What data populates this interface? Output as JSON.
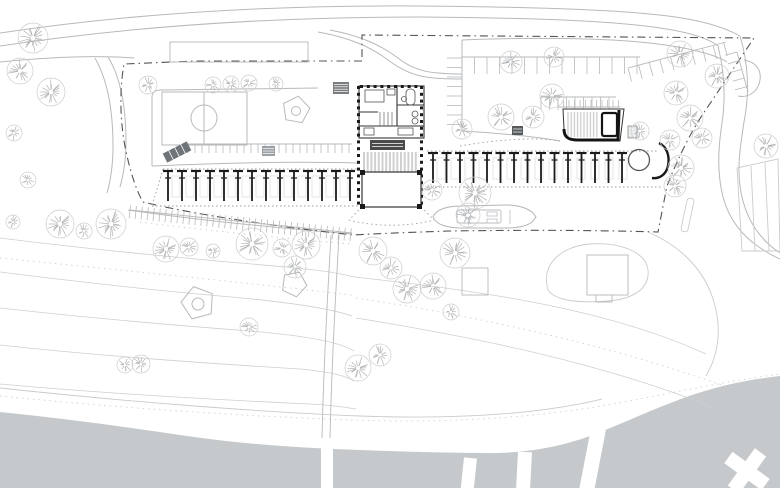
{
  "drawing_type": "architectural-site-plan",
  "colors": {
    "paper": "#ffffff",
    "water": "#c6c9cb",
    "line": "#b7b9bb",
    "faint": "#c9cbcd",
    "contour": "#cdcfd1",
    "tree": "#b2b4b6",
    "treeLight": "#cbcdcf",
    "dark": "#1a1a1c",
    "wall": "#333333",
    "boundary": "#545454",
    "deckStripe": "#d0d0d0",
    "stage": "#4a4a4a",
    "rampFill": "#6e7478",
    "boatFaint": "#dedede"
  },
  "site": {
    "water": {
      "shore": "M0,412 C60,418 120,426 180,435 C240,444 300,448 360,450 C410,452 455,453 490,453 C530,453 562,446 590,436 C622,424 652,409 692,395 C732,382 756,379 780,376 L780,488 L0,488 Z",
      "piers": [
        {
          "x": 321,
          "y": 438,
          "w": 12,
          "h": 52,
          "rot": 0
        },
        {
          "x": 464,
          "y": 458,
          "w": 13,
          "h": 32,
          "rot": 6
        },
        {
          "x": 518,
          "y": 452,
          "w": 14,
          "h": 38,
          "rot": 3
        },
        {
          "x": 591,
          "y": 429,
          "w": 15,
          "h": 62,
          "rot": 11
        }
      ],
      "cross": {
        "cx": 747,
        "cy": 471,
        "len": 46,
        "wid": 14,
        "rot": 36
      }
    },
    "contours": [
      "M0,238 C80,248 160,256 240,263 C300,268 332,271 354,277",
      "M0,272 C80,282 150,290 220,296 C290,302 332,309 352,316",
      "M0,308 C90,318 170,325 250,331 C310,336 342,343 354,351",
      "M0,345 C100,356 200,363 300,369 C332,372 346,376 354,381",
      "M0,384 C100,393 200,399 310,404 C330,405 344,407 356,409",
      "M354,277 C420,284 480,292 532,302 C600,315 660,333 706,354",
      "M356,318 C430,330 510,345 580,364 C636,379 680,394 714,408"
    ],
    "contours_dotted": [
      "M0,258 C120,270 240,282 352,295",
      "M356,298 C450,312 546,332 634,357 C684,372 722,385 752,395",
      "M0,396 C120,408 240,416 352,420 C470,424 560,415 640,399 C700,387 742,379 780,374",
      "M140,222 C220,232 300,240 352,244"
    ],
    "roads": [
      "M0,33 C140,12 280,5 420,6 C540,7 622,10 668,16 C700,20 724,27 740,36",
      "M0,46 C140,25 280,17 420,17 C540,18 614,21 660,28 C688,32 708,38 718,46",
      "M0,62 C50,57 96,55 134,58",
      "M108,57 C120,76 126,106 126,141 C126,159 124,173 120,187",
      "M95,58 C107,79 113,109 113,146 C113,164 111,179 107,193",
      "M318,32 C352,38 372,48 388,60 C400,69 412,75 426,77 C438,79 450,79 462,79",
      "M330,30 C362,36 382,46 398,58 C408,66 422,72 438,73 C448,74 456,74 462,74",
      "M740,36 C748,62 750,92 744,122 C740,148 736,172 742,197 C748,223 762,241 780,253",
      "M718,46 C724,70 726,96 722,123 C718,149 717,173 723,197 C729,219 741,235 759,247 C766,252 773,256 780,259",
      "M744,60 C757,62 763,72 759,84 C756,93 747,98 738,96",
      "M462,40 L462,131",
      "M462,40 C540,37 612,38 658,44 C690,48 716,55 727,62",
      "M462,131 C500,133 538,137 560,141",
      "M152,166 L152,97 C152,92 155,90 161,90 L318,88",
      "M152,166 C220,163 290,161 357,163",
      "M128,210 C190,219 265,227 352,234"
    ],
    "faint_paths": [
      "M737,168 L778,159 L780,251 L742,251 Z",
      "M751,166 L755,251",
      "M765,163 L769,251",
      "M548,290 C540,264 562,246 590,244 C620,242 646,252 648,270 C650,288 634,299 608,301 C584,303 556,302 548,290",
      "M648,232 C680,246 702,268 712,296 C722,324 720,352 706,376",
      "M0,388 C130,402 260,412 360,416 C470,420 548,412 602,399"
    ],
    "median": {
      "x": 684,
      "y": 198,
      "w": 7,
      "h": 34,
      "rot": 12
    },
    "boundary": "M362,61 L196,61 L124,64 C119,92 120,126 127,156 C131,173 136,190 143,202 C192,214 272,226 353,235 C390,233 420,232 450,231 C520,230 590,230 658,232 L667,186 C678,158 691,131 707,108 L754,38 L362,35 Z",
    "court": {
      "x": 162,
      "y": 92,
      "w": 85,
      "h": 53,
      "cx": 204,
      "cy": 118,
      "r": 13
    },
    "pentagons": [
      {
        "cx": 296,
        "cy": 110,
        "r": 14,
        "rot": -80,
        "ir": 4.5
      },
      {
        "cx": 198,
        "cy": 303,
        "r": 17,
        "rot": -105,
        "ir": 6
      },
      {
        "cx": 294,
        "cy": 284,
        "r": 13,
        "rot": -65,
        "ir": 0
      }
    ],
    "squares": [
      {
        "x": 170,
        "y": 42,
        "w": 138,
        "h": 20
      },
      {
        "x": 462,
        "y": 268,
        "w": 26,
        "h": 27
      },
      {
        "x": 587,
        "y": 255,
        "w": 41,
        "h": 40
      },
      {
        "x": 596,
        "y": 295,
        "w": 16,
        "h": 7
      }
    ],
    "tick_rows": [
      {
        "x1": 462,
        "y1": 57,
        "x2": 640,
        "y2": 57,
        "len": 17,
        "sp": 12.5,
        "side": 1
      },
      {
        "x1": 462,
        "y1": 58,
        "x2": 462,
        "y2": 130,
        "len": 15,
        "sp": 9.5,
        "side": 1
      },
      {
        "x1": 541,
        "y1": 97,
        "x2": 616,
        "y2": 97,
        "len": 13,
        "sp": 8.5,
        "side": 1
      },
      {
        "x1": 628,
        "y1": 68,
        "x2": 726,
        "y2": 42,
        "len": 14,
        "sp": 11,
        "side": 1
      },
      {
        "x1": 737,
        "y1": 52,
        "x2": 748,
        "y2": 92,
        "len": 12,
        "sp": 9,
        "side": 1
      },
      {
        "x1": 188,
        "y1": 144,
        "x2": 352,
        "y2": 144,
        "len": 9,
        "sp": 7,
        "side": 1
      },
      {
        "x1": 558,
        "y1": 107,
        "x2": 620,
        "y2": 107,
        "len": 7,
        "sp": 5.5,
        "side": -1
      },
      {
        "x1": 130,
        "y1": 210,
        "x2": 352,
        "y2": 233,
        "len": 13,
        "sp": 6,
        "side": 2
      }
    ],
    "rack_rows": [
      {
        "x0": 168,
        "x1": 350,
        "n": 14,
        "y": 171,
        "stem": 30,
        "boat_y": 176,
        "band": [
          "M163,169 L357,169",
          "M152,206 L362,206",
          "M163,169 L152,206"
        ]
      },
      {
        "x0": 433,
        "x1": 622,
        "n": 15,
        "y": 153,
        "stem": 30,
        "boat_y": 158,
        "band": [
          "M427,151 L657,151",
          "M427,187 L663,187"
        ]
      }
    ],
    "row_end": {
      "circle": {
        "cx": 639,
        "cy": 160,
        "r": 10.5
      },
      "hook": "M659,143 C667,147 670,156 668,166 C666,175 659,179 652,178"
    },
    "dotted_lines": [
      "M362,207 L349,220",
      "M421,207 L434,220",
      "M349,220 C375,227 408,227 434,220",
      "M460,146 C500,139 538,137 560,141"
    ],
    "mid_path": [
      "M331,235 C328,290 324,350 322,438",
      "M339,235 C336,290 332,350 330,438"
    ],
    "ramp": {
      "cx": 177,
      "cy": 152,
      "w": 27,
      "h": 10,
      "rot": -27
    },
    "dark_rects": [
      {
        "x": 333,
        "y": 82,
        "w": 16,
        "h": 12,
        "fill": "#7a7e81",
        "stroke": "none",
        "lines": 4
      },
      {
        "x": 262,
        "y": 146,
        "w": 13,
        "h": 10,
        "fill": "#9aa0a3",
        "stroke": "none",
        "lines": 3
      },
      {
        "x": 512,
        "y": 126,
        "w": 11,
        "h": 9,
        "fill": "#565a5d",
        "stroke": "none",
        "lines": 2
      },
      {
        "x": 628,
        "y": 126,
        "w": 9,
        "h": 12,
        "fill": "#e4e6e7",
        "stroke": "#8a8e91",
        "lines": 3
      }
    ],
    "main_building": {
      "block": {
        "x": 359,
        "y": 86,
        "w": 65,
        "h": 52
      },
      "walls": [
        "M359,126 L424,126",
        "M397,86 L397,126",
        "M397,105 L424,105",
        "M359,112 L378,112"
      ],
      "furn_rects": [
        [
          406,
          89,
          9,
          16,
          4
        ],
        [
          365,
          90,
          19,
          12,
          0
        ],
        [
          387,
          89,
          8,
          6,
          0
        ],
        [
          364,
          128,
          10,
          7,
          0
        ],
        [
          398,
          128,
          15,
          7,
          0
        ]
      ],
      "furn_circles": [
        [
          415,
          114,
          3
        ],
        [
          415,
          121,
          3
        ],
        [
          404,
          99,
          2.5
        ]
      ],
      "stair_lines": [
        "M380,112 L380,126",
        "M384,112 L384,126",
        "M388,112 L388,126",
        "M392,112 L392,126"
      ],
      "columns": {
        "x_left": 358.5,
        "x_right": 421.5,
        "y0": 86,
        "y1": 206,
        "step": 6.8,
        "top_y": 85,
        "top_x0": 360,
        "top_x1": 420,
        "top_step": 6.8,
        "size": 3
      },
      "stage": {
        "x": 370,
        "y": 140,
        "w": 35,
        "h": 10
      },
      "deck": {
        "x0": 364,
        "x1": 419,
        "y0": 152,
        "y1": 172,
        "step": 3.7
      },
      "hall": {
        "x": 362,
        "y": 172,
        "w": 59,
        "h": 35,
        "corners": [
          [
            360,
            170
          ],
          [
            417,
            170
          ],
          [
            360,
            204
          ],
          [
            417,
            204
          ]
        ],
        "corner_size": 5
      }
    },
    "annex": {
      "outline": "M563,109 L624,109 L620,141 L578,141 C568,141 564,137 564,129 Z",
      "heavy": "M564,129 C564,137 568,140 578,140 L618,140 L619,110",
      "stripes": {
        "x0": 568,
        "x1": 598,
        "step": 3.2,
        "y0": 112,
        "y1": 137
      },
      "d_rect": {
        "x": 602,
        "y": 113,
        "w": 15,
        "h": 23,
        "rx": 2
      }
    },
    "boat": {
      "hull": "M433,217 C436,209 448,206 462,206 L506,205 C520,205 529,209 533,213 L536,217 L532,222 C527,226 518,228 506,228 L462,228 C448,228 436,225 433,217 Z",
      "cabin": {
        "x": 457,
        "y": 210,
        "w": 44,
        "h": 13
      },
      "detail_rects": [
        [
          487,
          212,
          10,
          4
        ],
        [
          487,
          219,
          10,
          4
        ]
      ],
      "detail_circle": [
        468,
        216,
        3
      ],
      "detail_line": "M510,210 L510,224"
    },
    "trees": [
      [
        33,
        38,
        15
      ],
      [
        20,
        71,
        13
      ],
      [
        51,
        92,
        14
      ],
      [
        14,
        133,
        8
      ],
      [
        28,
        180,
        8
      ],
      [
        13,
        222,
        7
      ],
      [
        148,
        85,
        9
      ],
      [
        213,
        85,
        8
      ],
      [
        231,
        84,
        8
      ],
      [
        249,
        83,
        8
      ],
      [
        276,
        84,
        7
      ],
      [
        511,
        62,
        11
      ],
      [
        554,
        57,
        10
      ],
      [
        552,
        96,
        12
      ],
      [
        501,
        117,
        13
      ],
      [
        533,
        117,
        11
      ],
      [
        680,
        54,
        13
      ],
      [
        717,
        76,
        12
      ],
      [
        676,
        93,
        12
      ],
      [
        690,
        118,
        13
      ],
      [
        670,
        140,
        10
      ],
      [
        702,
        138,
        10
      ],
      [
        766,
        146,
        12
      ],
      [
        681,
        168,
        13
      ],
      [
        675,
        186,
        11
      ],
      [
        60,
        224,
        14
      ],
      [
        84,
        231,
        8
      ],
      [
        111,
        224,
        15
      ],
      [
        166,
        249,
        13
      ],
      [
        189,
        247,
        9
      ],
      [
        213,
        251,
        7
      ],
      [
        252,
        244,
        16
      ],
      [
        282,
        248,
        9
      ],
      [
        306,
        245,
        14
      ],
      [
        373,
        251,
        14
      ],
      [
        391,
        268,
        11
      ],
      [
        433,
        286,
        13
      ],
      [
        407,
        289,
        14
      ],
      [
        455,
        253,
        15
      ],
      [
        451,
        312,
        8
      ],
      [
        295,
        267,
        11
      ],
      [
        462,
        129,
        10
      ],
      [
        432,
        190,
        10
      ],
      [
        475,
        193,
        16
      ],
      [
        468,
        215,
        12
      ],
      [
        640,
        131,
        9
      ],
      [
        249,
        327,
        9
      ],
      [
        125,
        365,
        8
      ],
      [
        141,
        364,
        9
      ],
      [
        358,
        368,
        13
      ],
      [
        380,
        355,
        11
      ]
    ]
  }
}
